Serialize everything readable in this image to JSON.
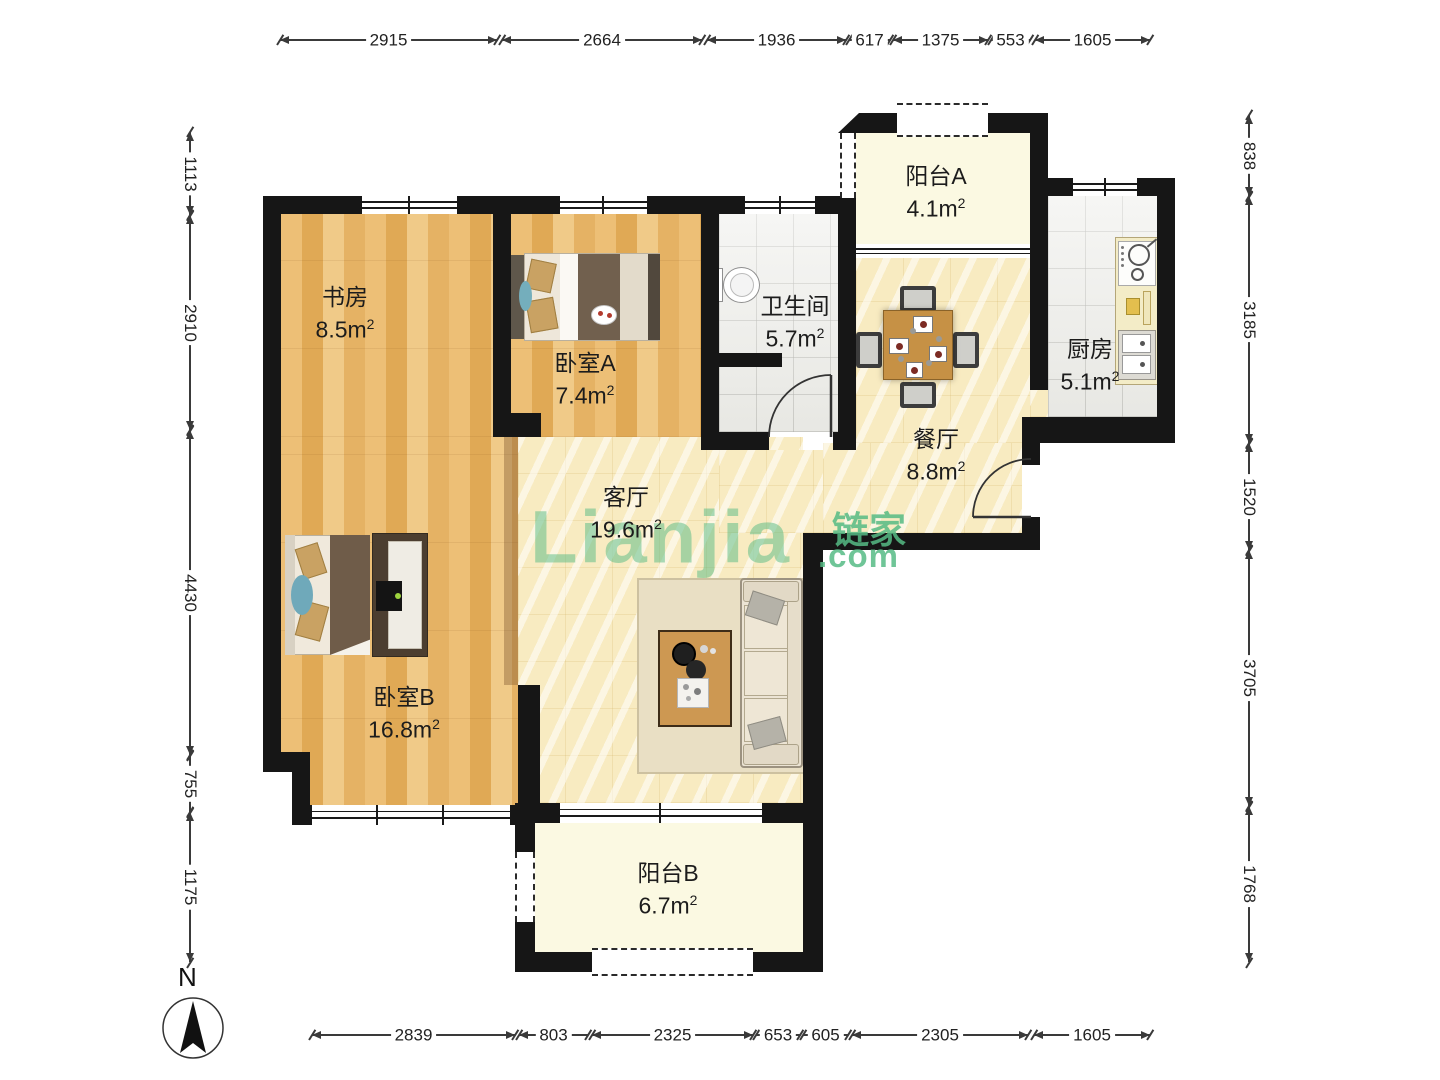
{
  "meta": {
    "compass_label": "N"
  },
  "watermark": {
    "latin": "Lianjia",
    "cjk": "链家",
    "suffix": ".com",
    "color": "#56bb85"
  },
  "area_unit": "m",
  "area_sup": "2",
  "rooms": {
    "study": {
      "name": "书房",
      "area": "8.5"
    },
    "bedroom_a": {
      "name": "卧室A",
      "area": "7.4"
    },
    "bathroom": {
      "name": "卫生间",
      "area": "5.7"
    },
    "balcony_a": {
      "name": "阳台A",
      "area": "4.1"
    },
    "kitchen": {
      "name": "厨房",
      "area": "5.1"
    },
    "dining": {
      "name": "餐厅",
      "area": "8.8"
    },
    "living": {
      "name": "客厅",
      "area": "19.6"
    },
    "bedroom_b": {
      "name": "卧室B",
      "area": "16.8"
    },
    "balcony_b": {
      "name": "阳台B",
      "area": "6.7"
    }
  },
  "dimensions": {
    "top": [
      "2915",
      "2664",
      "1936",
      "617",
      "1375",
      "553",
      "1605"
    ],
    "left": [
      "1113",
      "2910",
      "4430",
      "755",
      "1175"
    ],
    "right": [
      "838",
      "3185",
      "1520",
      "3705",
      "1768"
    ],
    "bottom": [
      "2839",
      "803",
      "2325",
      "653",
      "605",
      "2305",
      "1605"
    ]
  }
}
